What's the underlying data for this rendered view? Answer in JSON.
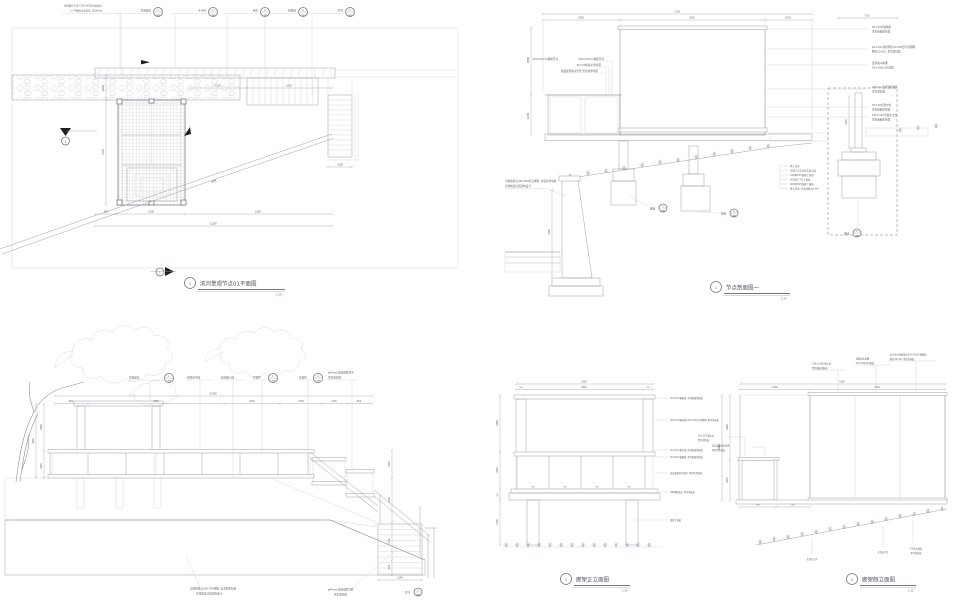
{
  "colors": {
    "paper": "#ffffff",
    "line": "#9aa0aa",
    "dark_line": "#747a84",
    "black": "#1f1f1f",
    "text": "#5d626b"
  },
  "plan": {
    "num": "1",
    "title": "滨河景观节点01平面图",
    "scale": "1:50",
    "note1": "台阶踏步100×350×40花岗岩面层",
    "note2": "1:2干硬性水泥砂浆, 厚30mm",
    "marker1": "1",
    "marker2": "1",
    "slope_label": "坡道",
    "callouts": [
      {
        "label": "景观廊架",
        "num": "1",
        "sub": "详图"
      },
      {
        "label": "木平台",
        "num": "2",
        "sub": "详图"
      },
      {
        "label": "台阶",
        "num": "3",
        "sub": "详图"
      },
      {
        "label": "种植池",
        "num": "4",
        "sub": "详图"
      },
      {
        "label": "栏杆",
        "num": "5",
        "sub": "详图"
      }
    ],
    "dims_bottom": [
      "880",
      "3300",
      "8100"
    ],
    "dim_total": "12280",
    "dims_left": [
      "1050",
      "5250"
    ],
    "dims_top": [
      "2150",
      "3230"
    ],
    "dim_stair": "1080"
  },
  "section": {
    "num": "1",
    "title": "节点剖面图一",
    "scale": "1:20",
    "dim_total": "7100",
    "dims_top": [
      "1800",
      "3500",
      "1050"
    ],
    "dim_right": "750",
    "dims_left": [
      "2000",
      "1200"
    ],
    "dim_post": "1650",
    "dim_wall": "2100",
    "left_notes": [
      "120×50mm横梁压顶",
      "30×50防腐木条饰面",
      "成品菠萝格木坐凳 黑色烤漆饰面"
    ],
    "right_notes": [
      [
        "50×50方钢横梁",
        "黑色氟碳漆饰面"
      ],
      [
        "φ2.0mm钢丝网片50×50目不锈钢网",
        "网孔50×50, 黑色漆饰面"
      ],
      [
        "菠萝格木格栅",
        "25×50@150饰面"
      ],
      [
        "φ50mm镀锌钢管横梁",
        "黑色漆饰面"
      ],
      [
        "50×50方钢立柱",
        "黑色氟碳漆饰面"
      ],
      [
        "120×120方钢主立柱",
        "黑色氟碳漆饰面"
      ]
    ],
    "wall_note": [
      "当地龟纹石200-300毛石砌筑, 水泥砂浆勾缝",
      "具体做法详见结构设计"
    ],
    "base_layers": [
      "素土夯实",
      "30厚1:3水泥砂浆结合层",
      "100厚C15混凝土垫层",
      "300厚3:7灰土垫层",
      "200厚C25混凝土基础",
      "素土夯实, 压实系数≥0.94"
    ],
    "callout1": {
      "label": "基础",
      "num": "1",
      "sub": "详图"
    },
    "callout2": {
      "label": "基础",
      "num": "1",
      "sub": "详图"
    },
    "callout3": {
      "label": "基础",
      "num": "2",
      "sub": "详图"
    }
  },
  "elev": {
    "leaders": [
      {
        "label": "景观廊架",
        "num": "1",
        "sub": "详图"
      },
      {
        "label": "参照地平线"
      },
      {
        "label": "绿化覆土线"
      },
      {
        "label": "景墙柱",
        "num": "1",
        "sub": "详图"
      },
      {
        "label": "景墙柱",
        "num": "2",
        "sub": "详图"
      },
      {
        "label": "φ40mm镀锌钢管扶手",
        "label2": "黑色漆饰面"
      }
    ],
    "dim_total": "12280",
    "dims_top": [
      "880",
      "5200",
      "2600",
      "1500",
      "1250",
      "850"
    ],
    "dims_left": [
      "1800",
      "1050"
    ],
    "dim_left_total": "2850",
    "dims_right": [
      "1050",
      "1700",
      "1450",
      "600"
    ],
    "dim_stair": "1080",
    "note_wall": [
      "当地龟纹石200-300砌筑, 水泥砂浆勾缝",
      "具体做法详见结构设计"
    ],
    "note_rail": [
      "φ40mm镀锌钢管立柱",
      "黑色漆饰面"
    ],
    "callout_rail": {
      "label": "栏杆",
      "num": "1",
      "sub": "详图"
    }
  },
  "front": {
    "num": "1",
    "title": "廊架正立面图",
    "scale": "1:30",
    "dim_total": "3300",
    "dims_top": [
      "250",
      "2800",
      "250"
    ],
    "dims_left": [
      "1800",
      "1050",
      "300",
      "1350"
    ],
    "dims_mid": [
      "700",
      "700",
      "700",
      "700"
    ],
    "right_notes": [
      "50×50方钢横梁, 黑色氟碳漆饰面",
      "φ2.0mm钢丝网片50×50目不锈钢网, 黑色漆饰面",
      "50×50方钢次梁, 黑色氟碳漆饰面",
      "50×50方钢横梁, 黑色氟碳漆饰面",
      "成品菠萝格木坐凳, 黑色烤漆饰面",
      "3厚钢板收边, 黑色漆饰面",
      "混凝土基础"
    ]
  },
  "side": {
    "num": "2",
    "title": "廊架侧立面图",
    "scale": "1:30",
    "dim_total": "5300",
    "dims_top": [
      "1800",
      "3500"
    ],
    "dims_left": [
      "1800",
      "1050"
    ],
    "dim_left_total": "2850",
    "dims_bottom": [
      "950",
      "900"
    ],
    "top_notes": [
      [
        "120×120方钢立柱",
        "黑色氟碳漆饰面"
      ],
      [
        "菠萝格木格栅",
        "25×50@150饰面"
      ],
      [
        "φ2.0mm钢丝网片50×50目不锈钢网",
        "网孔50×50, 黑色漆饰面"
      ]
    ],
    "left_notes": [
      [
        "50×50方钢立柱",
        "黑色漆饰面"
      ],
      [
        "成品菠萝格木坐凳",
        "黑色烤漆饰面"
      ]
    ],
    "bottom_notes": [
      "文化石汀步",
      "文化石汀步",
      "2%排水坡度",
      "黑色漆饰面"
    ]
  }
}
